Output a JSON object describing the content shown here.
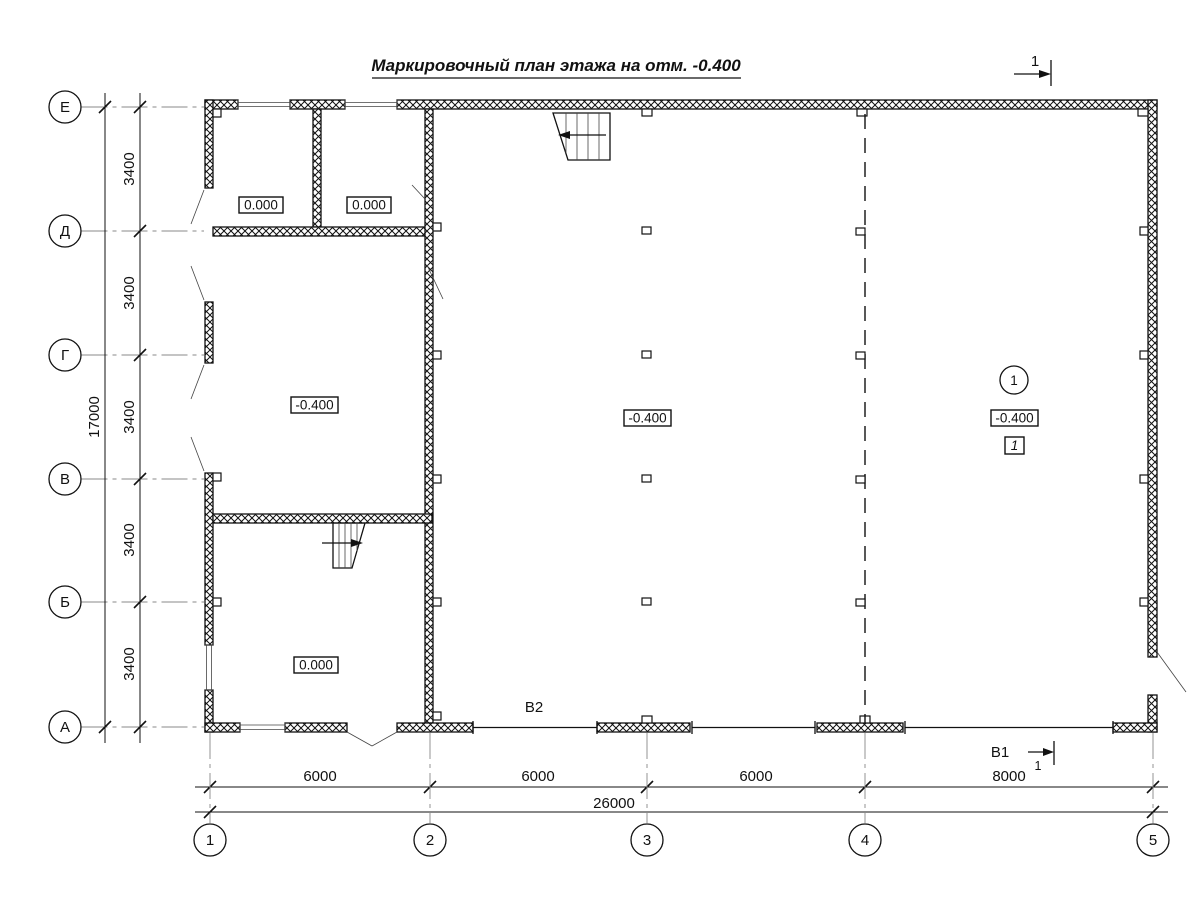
{
  "title": "Маркировочный план этажа на отм. -0.400",
  "grid": {
    "rows": [
      "Е",
      "Д",
      "Г",
      "В",
      "Б",
      "А"
    ],
    "cols": [
      "1",
      "2",
      "3",
      "4",
      "5"
    ]
  },
  "dimensions": {
    "row_spans": [
      "3400",
      "3400",
      "3400",
      "3400",
      "3400"
    ],
    "row_total": "17000",
    "col_spans": [
      "6000",
      "6000",
      "6000",
      "8000"
    ],
    "col_total": "26000"
  },
  "elevations": {
    "top_left_room": "0.000",
    "top_mid_room": "0.000",
    "left_room": "-0.400",
    "center_hall": "-0.400",
    "right_hall": "-0.400",
    "bottom_left_room": "0.000"
  },
  "marks": {
    "section_top": "1",
    "section_bottom_label": "В1",
    "section_bottom_num": "1",
    "utility": "В2",
    "position_circle": "1",
    "position_box": "1"
  }
}
